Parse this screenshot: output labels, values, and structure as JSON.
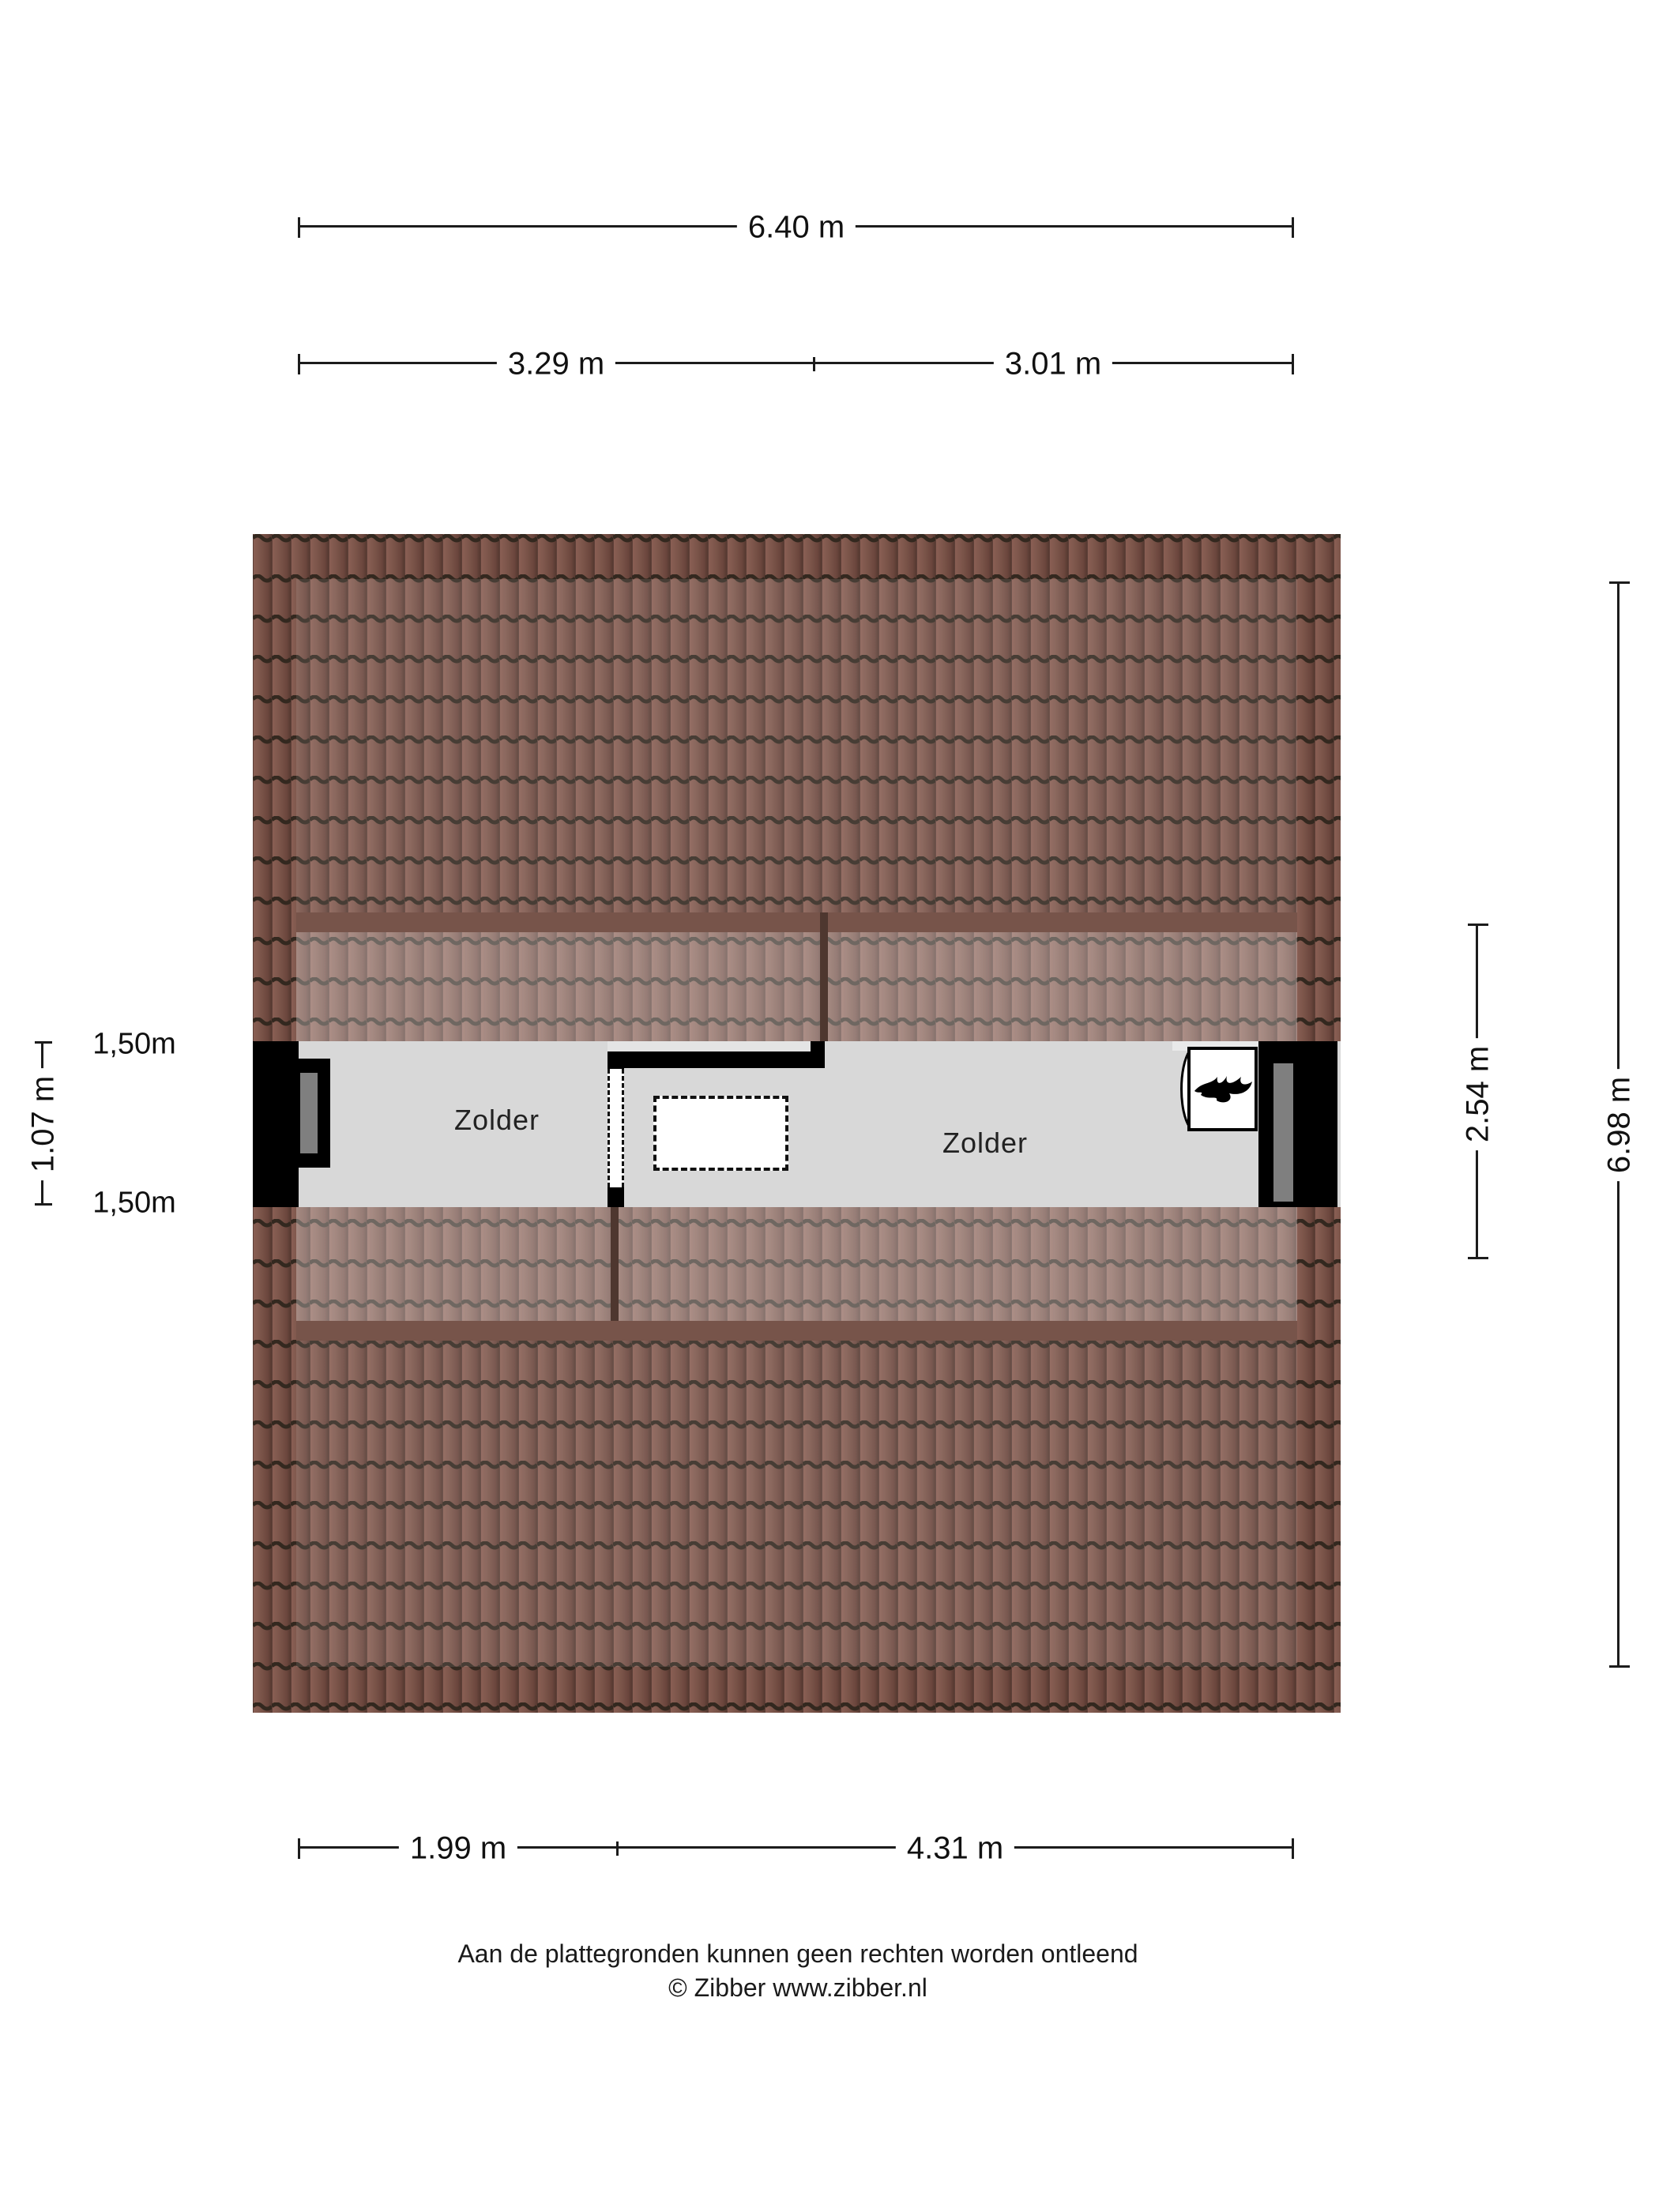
{
  "palette": {
    "page_bg": "#ffffff",
    "wall": "#000000",
    "floor": "#d8d8d8",
    "window_pane": "#7f7f7f",
    "dim_line": "#1c1c1c",
    "roof_base": "#7a5449",
    "roof_gap_dark": "#33281f",
    "roof_light_band": "#a8837a"
  },
  "plan": {
    "rooms": [
      {
        "label": "Zolder"
      },
      {
        "label": "Zolder"
      }
    ]
  },
  "dimensions": {
    "top_total": "6.40 m",
    "top_left": "3.29 m",
    "top_right": "3.01 m",
    "left_upper": "1,50m",
    "left_total": "1.07 m",
    "left_lower": "1,50m",
    "right_room": "2.54 m",
    "right_total": "6.98 m",
    "bottom_left": "1.99 m",
    "bottom_right": "4.31 m"
  },
  "footer": {
    "disclaimer": "Aan de plattegronden kunnen geen rechten worden ontleend",
    "copyright": "© Zibber www.zibber.nl"
  }
}
